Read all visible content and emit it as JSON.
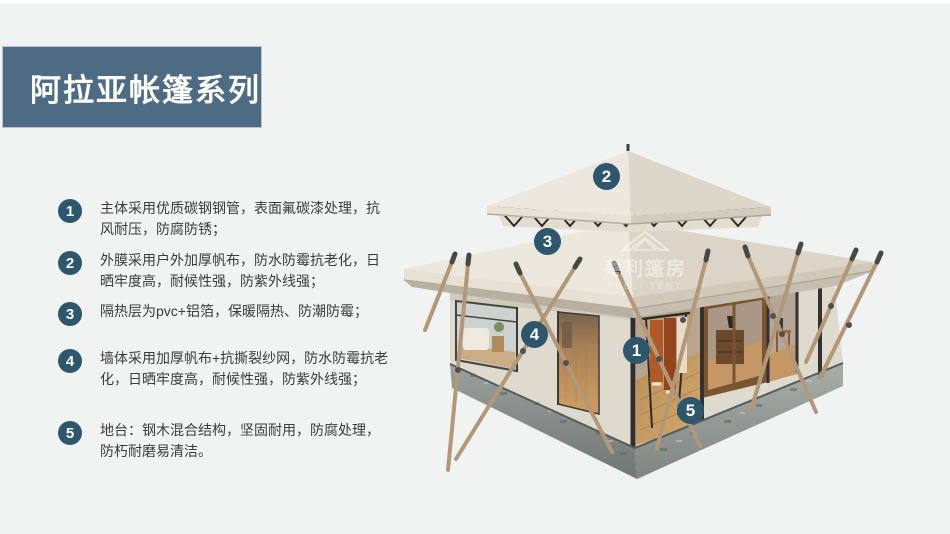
{
  "page": {
    "background": "#f1f2f2"
  },
  "title": {
    "text": "阿拉亚帐篷系列",
    "bg_color": "#4e6b84",
    "text_color": "#ffffff"
  },
  "features": [
    {
      "num": "1",
      "text": "主体采用优质碳钢钢管，表面氟碳漆处理，抗风耐压，防腐防锈；"
    },
    {
      "num": "2",
      "text": "外膜采用户外加厚帆布，防水防霉抗老化，日晒牢度高，耐候性强，防紫外线强；"
    },
    {
      "num": "3",
      "text": "隔热层为pvc+铝箔，保暖隔热、防潮防霉；"
    },
    {
      "num": "4",
      "text": "墙体采用加厚帆布+抗撕裂纱网，防水防霉抗老化，日晒牢度高，耐候性强，防紫外线强；"
    },
    {
      "num": "5",
      "text": "地台：钢木混合结构，坚固耐用，防腐处理，防朽耐磨易清洁。"
    }
  ],
  "diagram": {
    "markers": [
      {
        "num": "1"
      },
      {
        "num": "2"
      },
      {
        "num": "3"
      },
      {
        "num": "4"
      },
      {
        "num": "5"
      }
    ],
    "marker_color": "#2e566c",
    "watermark": {
      "cn": "粤利篷房",
      "en": "YUELI TENT"
    },
    "colors": {
      "roof_light": "#ece8dd",
      "roof_dark": "#dcd5c7",
      "canvas_wall": "#dedacd",
      "platform": "#8e9391",
      "pole": "#b29878",
      "wood_floor": "#c79a61"
    }
  }
}
